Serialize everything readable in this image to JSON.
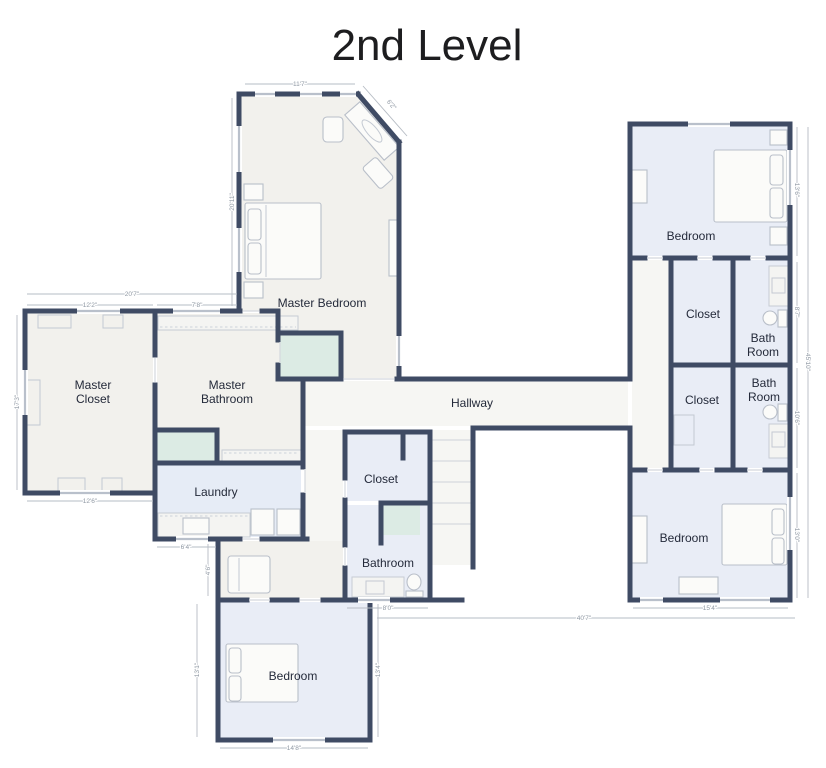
{
  "title": "2nd Level",
  "colors": {
    "wall": "#3f4b64",
    "room_neutral": "#f2f1ed",
    "room_blue": "#e9edf6",
    "room_green": "#dcebe4",
    "hallway": "#f6f6f3",
    "window": "#b9c0cb",
    "dimension_text": "#8f98a3",
    "label_text": "#242a3a"
  },
  "rooms": {
    "master_bedroom": {
      "label": "Master Bedroom"
    },
    "master_closet": {
      "label_line1": "Master",
      "label_line2": "Closet"
    },
    "master_bathroom": {
      "label_line1": "Master",
      "label_line2": "Bathroom"
    },
    "laundry": {
      "label": "Laundry"
    },
    "hallway": {
      "label": "Hallway"
    },
    "closet_center": {
      "label": "Closet"
    },
    "bathroom_center": {
      "label": "Bathroom"
    },
    "bedroom_bottom_left": {
      "label": "Bedroom"
    },
    "bedroom_top_right": {
      "label": "Bedroom"
    },
    "closet_right_upper": {
      "label": "Closet"
    },
    "bath_right_upper": {
      "label_line1": "Bath",
      "label_line2": "Room"
    },
    "closet_right_lower": {
      "label": "Closet"
    },
    "bath_right_lower": {
      "label_line1": "Bath",
      "label_line2": "Room"
    },
    "bedroom_bottom_right": {
      "label": "Bedroom"
    }
  },
  "dimensions": {
    "master_bedroom_top": "11'7\"",
    "master_bedroom_diagonal": "6'2\"",
    "master_bedroom_left": "20'11\"",
    "left_wing_total_top": "20'7\"",
    "master_closet_top": "12'2\"",
    "master_bathroom_top": "7'8\"",
    "master_closet_left": "17'3\"",
    "master_closet_bottom": "12'6\"",
    "laundry_bottom": "6'4\"",
    "entry_left": "4'6\"",
    "bedroom_bl_left": "13'1\"",
    "bedroom_bl_right": "13'4\"",
    "bedroom_bl_bottom": "14'8\"",
    "bathroom_center_bottom": "8'0\"",
    "bedroom_br_bottom": "15'4\"",
    "overall_bottom": "40'7\"",
    "bedroom_tr_right": "13'6\"",
    "bath_right_upper_side": "8'7\"",
    "bath_right_lower_side": "10'6\"",
    "bedroom_br_right": "13'0\"",
    "right_wing_total": "45'10\""
  }
}
